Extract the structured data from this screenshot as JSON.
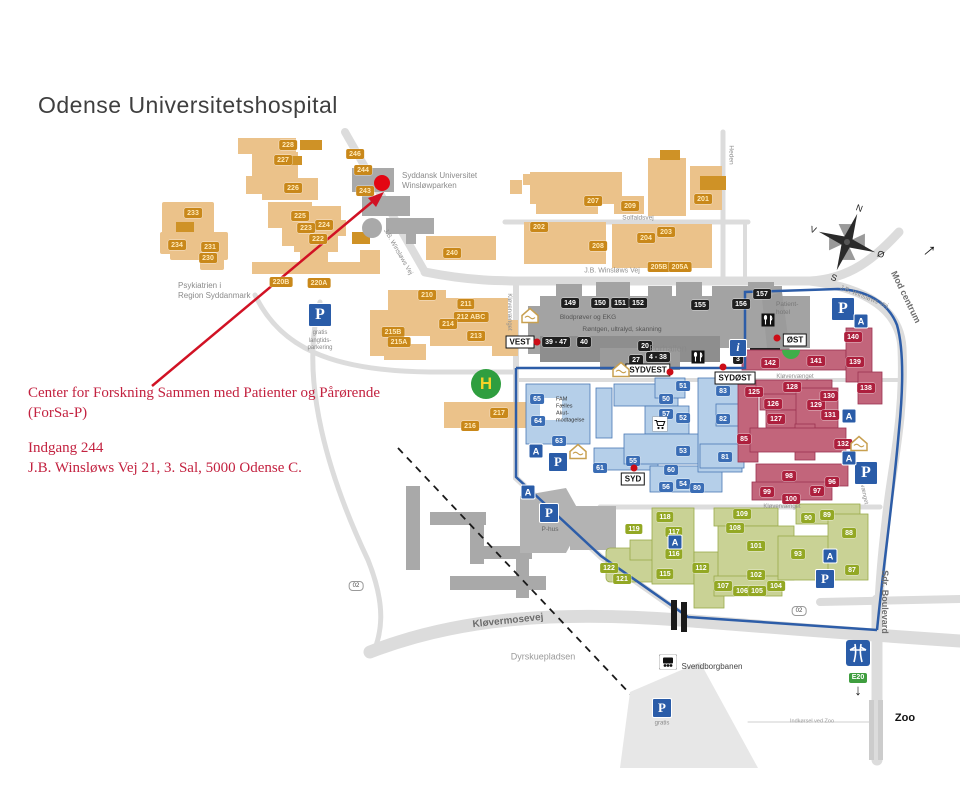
{
  "title": "Odense Universitetshospital",
  "annotation": {
    "line1": "Center for Forskning Sammen med Patienter og Pårørende",
    "line2": "(ForSa-P)",
    "line3": "Indgang 244",
    "line4": "J.B. Winsløws Vej 21, 3. Sal,  5000 Odense C.",
    "color": "#c32240"
  },
  "map": {
    "colors": {
      "orange_zone": "#ebc28a",
      "orange_chip": "#c9881a",
      "gray_zone": "#a5a5a5",
      "gray_chip": "#1f1f1f",
      "blue_zone": "#b5cfe9",
      "blue_chip": "#3a6db5",
      "red_zone": "#c2657b",
      "red_chip": "#ad1f3d",
      "green_zone": "#c9d295",
      "green_chip": "#93a824",
      "ring_road": "#2d5da8",
      "road": "#dcdcdc",
      "destination": "#e30613"
    },
    "buildings": {
      "orange": [
        {
          "n": "228",
          "x": 288,
          "y": 145
        },
        {
          "n": "227",
          "x": 283,
          "y": 160
        },
        {
          "n": "226",
          "x": 293,
          "y": 188
        },
        {
          "n": "246",
          "x": 355,
          "y": 154
        },
        {
          "n": "244",
          "x": 363,
          "y": 170
        },
        {
          "n": "243",
          "x": 365,
          "y": 191
        },
        {
          "n": "233",
          "x": 193,
          "y": 213
        },
        {
          "n": "234",
          "x": 177,
          "y": 245
        },
        {
          "n": "231",
          "x": 210,
          "y": 247
        },
        {
          "n": "230",
          "x": 208,
          "y": 258
        },
        {
          "n": "225",
          "x": 300,
          "y": 216
        },
        {
          "n": "224",
          "x": 324,
          "y": 225
        },
        {
          "n": "223",
          "x": 306,
          "y": 228
        },
        {
          "n": "222",
          "x": 318,
          "y": 239
        },
        {
          "n": "220B",
          "x": 281,
          "y": 282
        },
        {
          "n": "220A",
          "x": 319,
          "y": 283
        },
        {
          "n": "240",
          "x": 452,
          "y": 253
        },
        {
          "n": "207",
          "x": 593,
          "y": 201
        },
        {
          "n": "209",
          "x": 630,
          "y": 206
        },
        {
          "n": "202",
          "x": 539,
          "y": 227
        },
        {
          "n": "208",
          "x": 598,
          "y": 246
        },
        {
          "n": "204",
          "x": 646,
          "y": 238
        },
        {
          "n": "203",
          "x": 666,
          "y": 232
        },
        {
          "n": "205B",
          "x": 659,
          "y": 267
        },
        {
          "n": "205A",
          "x": 680,
          "y": 267
        },
        {
          "n": "201",
          "x": 703,
          "y": 199
        },
        {
          "n": "210",
          "x": 427,
          "y": 295
        },
        {
          "n": "211",
          "x": 466,
          "y": 304
        },
        {
          "n": "212 ABC",
          "x": 471,
          "y": 317
        },
        {
          "n": "214",
          "x": 448,
          "y": 324
        },
        {
          "n": "213",
          "x": 476,
          "y": 336
        },
        {
          "n": "215B",
          "x": 393,
          "y": 332
        },
        {
          "n": "215A",
          "x": 399,
          "y": 342
        },
        {
          "n": "217",
          "x": 499,
          "y": 413
        },
        {
          "n": "216",
          "x": 470,
          "y": 426
        }
      ],
      "gray": [
        {
          "n": "149",
          "x": 570,
          "y": 303
        },
        {
          "n": "150",
          "x": 600,
          "y": 303
        },
        {
          "n": "151",
          "x": 620,
          "y": 303
        },
        {
          "n": "152",
          "x": 638,
          "y": 303
        },
        {
          "n": "155",
          "x": 700,
          "y": 305
        },
        {
          "n": "156",
          "x": 741,
          "y": 304
        },
        {
          "n": "157",
          "x": 762,
          "y": 294
        },
        {
          "n": "39 - 47",
          "x": 556,
          "y": 342
        },
        {
          "n": "40",
          "x": 584,
          "y": 342
        },
        {
          "n": "20",
          "x": 645,
          "y": 346
        },
        {
          "n": "27",
          "x": 636,
          "y": 360
        },
        {
          "n": "4 - 38",
          "x": 658,
          "y": 357
        },
        {
          "n": "3",
          "x": 738,
          "y": 359
        }
      ],
      "blue": [
        {
          "n": "65",
          "x": 537,
          "y": 399
        },
        {
          "n": "64",
          "x": 538,
          "y": 421
        },
        {
          "n": "63",
          "x": 559,
          "y": 441
        },
        {
          "n": "61",
          "x": 600,
          "y": 468
        },
        {
          "n": "55",
          "x": 633,
          "y": 461
        },
        {
          "n": "60",
          "x": 671,
          "y": 470
        },
        {
          "n": "56",
          "x": 666,
          "y": 487
        },
        {
          "n": "54",
          "x": 683,
          "y": 484
        },
        {
          "n": "80",
          "x": 697,
          "y": 488
        },
        {
          "n": "53",
          "x": 683,
          "y": 451
        },
        {
          "n": "51",
          "x": 683,
          "y": 386
        },
        {
          "n": "50",
          "x": 666,
          "y": 399
        },
        {
          "n": "57",
          "x": 666,
          "y": 414
        },
        {
          "n": "52",
          "x": 683,
          "y": 418
        },
        {
          "n": "82",
          "x": 723,
          "y": 419
        },
        {
          "n": "81",
          "x": 725,
          "y": 457
        },
        {
          "n": "83",
          "x": 723,
          "y": 391
        }
      ],
      "red": [
        {
          "n": "142",
          "x": 770,
          "y": 363
        },
        {
          "n": "141",
          "x": 816,
          "y": 361
        },
        {
          "n": "140",
          "x": 853,
          "y": 337
        },
        {
          "n": "139",
          "x": 855,
          "y": 362
        },
        {
          "n": "138",
          "x": 866,
          "y": 388
        },
        {
          "n": "125",
          "x": 754,
          "y": 392
        },
        {
          "n": "128",
          "x": 792,
          "y": 387
        },
        {
          "n": "126",
          "x": 773,
          "y": 404
        },
        {
          "n": "129",
          "x": 816,
          "y": 405
        },
        {
          "n": "130",
          "x": 829,
          "y": 396
        },
        {
          "n": "131",
          "x": 830,
          "y": 415
        },
        {
          "n": "127",
          "x": 776,
          "y": 419
        },
        {
          "n": "85",
          "x": 744,
          "y": 439
        },
        {
          "n": "132",
          "x": 843,
          "y": 444
        },
        {
          "n": "98",
          "x": 789,
          "y": 476
        },
        {
          "n": "96",
          "x": 832,
          "y": 482
        },
        {
          "n": "99",
          "x": 767,
          "y": 492
        },
        {
          "n": "97",
          "x": 817,
          "y": 491
        },
        {
          "n": "100",
          "x": 791,
          "y": 499
        }
      ],
      "green": [
        {
          "n": "118",
          "x": 665,
          "y": 517
        },
        {
          "n": "119",
          "x": 634,
          "y": 529
        },
        {
          "n": "117",
          "x": 674,
          "y": 532
        },
        {
          "n": "116",
          "x": 674,
          "y": 554
        },
        {
          "n": "115",
          "x": 665,
          "y": 574
        },
        {
          "n": "122",
          "x": 609,
          "y": 568
        },
        {
          "n": "121",
          "x": 622,
          "y": 579
        },
        {
          "n": "112",
          "x": 701,
          "y": 568
        },
        {
          "n": "109",
          "x": 742,
          "y": 514
        },
        {
          "n": "108",
          "x": 735,
          "y": 528
        },
        {
          "n": "101",
          "x": 756,
          "y": 546
        },
        {
          "n": "102",
          "x": 756,
          "y": 575
        },
        {
          "n": "107",
          "x": 723,
          "y": 586
        },
        {
          "n": "106",
          "x": 742,
          "y": 591
        },
        {
          "n": "105",
          "x": 757,
          "y": 591
        },
        {
          "n": "104",
          "x": 776,
          "y": 586
        },
        {
          "n": "93",
          "x": 798,
          "y": 554
        },
        {
          "n": "90",
          "x": 808,
          "y": 518
        },
        {
          "n": "89",
          "x": 827,
          "y": 515
        },
        {
          "n": "88",
          "x": 849,
          "y": 533
        },
        {
          "n": "87",
          "x": 852,
          "y": 570
        }
      ]
    },
    "street_labels": [
      {
        "text": "J.B. Winsløws Vej",
        "x": 398,
        "y": 252,
        "rot": 60,
        "size": 6.5
      },
      {
        "text": "J.B. Winsløws Vej",
        "x": 612,
        "y": 271,
        "rot": 0,
        "size": 7
      },
      {
        "text": "J.B. Winsløws Vej",
        "x": 864,
        "y": 297,
        "rot": 22,
        "size": 6.5
      },
      {
        "text": "Solfaldsvej",
        "x": 638,
        "y": 218,
        "rot": 0,
        "size": 6.5
      },
      {
        "text": "Heden",
        "x": 731,
        "y": 155,
        "rot": 90,
        "size": 6.5
      },
      {
        "text": "Kløvervænget",
        "x": 509,
        "y": 312,
        "rot": 90,
        "size": 6
      },
      {
        "text": "Kløvervænget",
        "x": 795,
        "y": 377,
        "rot": 0,
        "size": 6
      },
      {
        "text": "Kløvervænget",
        "x": 782,
        "y": 507,
        "rot": 0,
        "size": 6
      },
      {
        "text": "Kløvervænget",
        "x": 862,
        "y": 486,
        "rot": 78,
        "size": 6
      },
      {
        "text": "Kløvermosevej",
        "x": 508,
        "y": 621,
        "rot": -6,
        "size": 10,
        "bold": true
      },
      {
        "text": "Sdr. Boulevard",
        "x": 885,
        "y": 602,
        "rot": 90,
        "size": 9,
        "bold": true
      },
      {
        "text": "Mod centrum",
        "x": 906,
        "y": 297,
        "rot": 64,
        "size": 9,
        "bold": true
      }
    ],
    "area_labels": [
      {
        "text": "Syddansk Universitet\nWinsløwparken",
        "x": 402,
        "y": 181,
        "size": 8,
        "align": "left",
        "color": "#8b8b8b"
      },
      {
        "text": "Psykiatrien i\nRegion Syddanmark",
        "x": 178,
        "y": 291,
        "size": 8,
        "align": "left",
        "color": "#8b8b8b"
      },
      {
        "text": "Patient-\nhotel",
        "x": 776,
        "y": 309,
        "size": 6.5,
        "align": "left",
        "color": "#777777"
      },
      {
        "text": "Forhallen",
        "x": 668,
        "y": 349,
        "size": 9,
        "color": "#8a8a8a"
      },
      {
        "text": "Blodprøver og EKG",
        "x": 588,
        "y": 318,
        "size": 6.5,
        "color": "#555555"
      },
      {
        "text": "Røntgen, ultralyd, skanning",
        "x": 622,
        "y": 330,
        "size": 6.5,
        "color": "#555555"
      },
      {
        "text": "FAM\nFælles\nAkut-\nmodtagelse",
        "x": 556,
        "y": 410,
        "size": 5.5,
        "align": "left",
        "color": "#333333"
      },
      {
        "text": "Dyrskuepladsen",
        "x": 543,
        "y": 657,
        "size": 9,
        "color": "#9a9a9a"
      },
      {
        "text": "Svendborgbanen",
        "x": 712,
        "y": 667,
        "size": 8,
        "color": "#444444"
      },
      {
        "text": "Zoo",
        "x": 905,
        "y": 719,
        "size": 11,
        "bold": true,
        "color": "#111111"
      },
      {
        "text": "Indkørsel ved Zoo",
        "x": 812,
        "y": 722,
        "size": 5.5,
        "color": "#9a9a9a"
      },
      {
        "text": "gratis\nlangtids-\nparkering",
        "x": 320,
        "y": 341,
        "size": 6,
        "color": "#888888"
      },
      {
        "text": "P-hus",
        "x": 550,
        "y": 530,
        "size": 6.5,
        "color": "#666666"
      },
      {
        "text": "gratis",
        "x": 662,
        "y": 724,
        "size": 6,
        "color": "#888888"
      }
    ],
    "entrances": [
      {
        "name": "VEST",
        "x": 520,
        "y": 342,
        "dot_dx": 17,
        "dot_dy": 0
      },
      {
        "name": "SYDVEST",
        "x": 648,
        "y": 370,
        "dot_dx": 22,
        "dot_dy": 2
      },
      {
        "name": "SYDØST",
        "x": 735,
        "y": 378,
        "dot_dx": -12,
        "dot_dy": -11
      },
      {
        "name": "ØST",
        "x": 795,
        "y": 340,
        "dot_dx": -18,
        "dot_dy": -2
      },
      {
        "name": "SYD",
        "x": 633,
        "y": 479,
        "dot_dx": 1,
        "dot_dy": -11
      }
    ],
    "icon_glyphs": {
      "parking": "P",
      "bus": "A",
      "info": "i"
    },
    "icons": [
      {
        "type": "parking",
        "x": 320,
        "y": 315,
        "s": 22
      },
      {
        "type": "parking",
        "x": 843,
        "y": 309,
        "s": 22
      },
      {
        "type": "parking",
        "x": 866,
        "y": 473,
        "s": 22
      },
      {
        "type": "parking",
        "x": 558,
        "y": 462,
        "s": 18
      },
      {
        "type": "parking",
        "x": 549,
        "y": 513,
        "s": 18
      },
      {
        "type": "parking",
        "x": 825,
        "y": 579,
        "s": 18
      },
      {
        "type": "parking",
        "x": 662,
        "y": 708,
        "s": 18
      },
      {
        "type": "bus",
        "x": 536,
        "y": 451,
        "s": 13
      },
      {
        "type": "bus",
        "x": 528,
        "y": 492,
        "s": 13
      },
      {
        "type": "bus",
        "x": 675,
        "y": 542,
        "s": 13
      },
      {
        "type": "bus",
        "x": 830,
        "y": 556,
        "s": 13
      },
      {
        "type": "bus",
        "x": 849,
        "y": 416,
        "s": 13
      },
      {
        "type": "bus",
        "x": 849,
        "y": 458,
        "s": 13
      },
      {
        "type": "bus",
        "x": 861,
        "y": 321,
        "s": 13
      },
      {
        "type": "info",
        "x": 738,
        "y": 348,
        "s": 16
      },
      {
        "type": "restaurant",
        "x": 698,
        "y": 357,
        "s": 13
      },
      {
        "type": "restaurant",
        "x": 768,
        "y": 320,
        "s": 13
      },
      {
        "type": "chapel",
        "x": 530,
        "y": 315,
        "s": 20
      },
      {
        "type": "chapel",
        "x": 621,
        "y": 369,
        "s": 20
      },
      {
        "type": "chapel",
        "x": 578,
        "y": 451,
        "s": 20
      },
      {
        "type": "chapel",
        "x": 859,
        "y": 443,
        "s": 20
      },
      {
        "type": "cart",
        "x": 660,
        "y": 424,
        "s": 15
      },
      {
        "type": "train",
        "x": 668,
        "y": 662,
        "s": 18
      }
    ],
    "road_badges": [
      {
        "text": "02",
        "x": 356,
        "y": 586
      },
      {
        "text": "02",
        "x": 799,
        "y": 611
      }
    ],
    "special": {
      "destination": {
        "x": 382,
        "y": 183,
        "r": 8
      },
      "helipad": {
        "x": 486,
        "y": 384,
        "label": "H"
      },
      "e20": {
        "x": 858,
        "y": 640,
        "label": "E20",
        "arrow": "↓"
      },
      "compass": {
        "x": 847,
        "y": 242,
        "rot": 20,
        "n": "N",
        "e": "Ø",
        "s": "S",
        "w": "V"
      },
      "centrum_arrow": {
        "x": 928,
        "y": 249,
        "glyph": "→"
      }
    }
  }
}
